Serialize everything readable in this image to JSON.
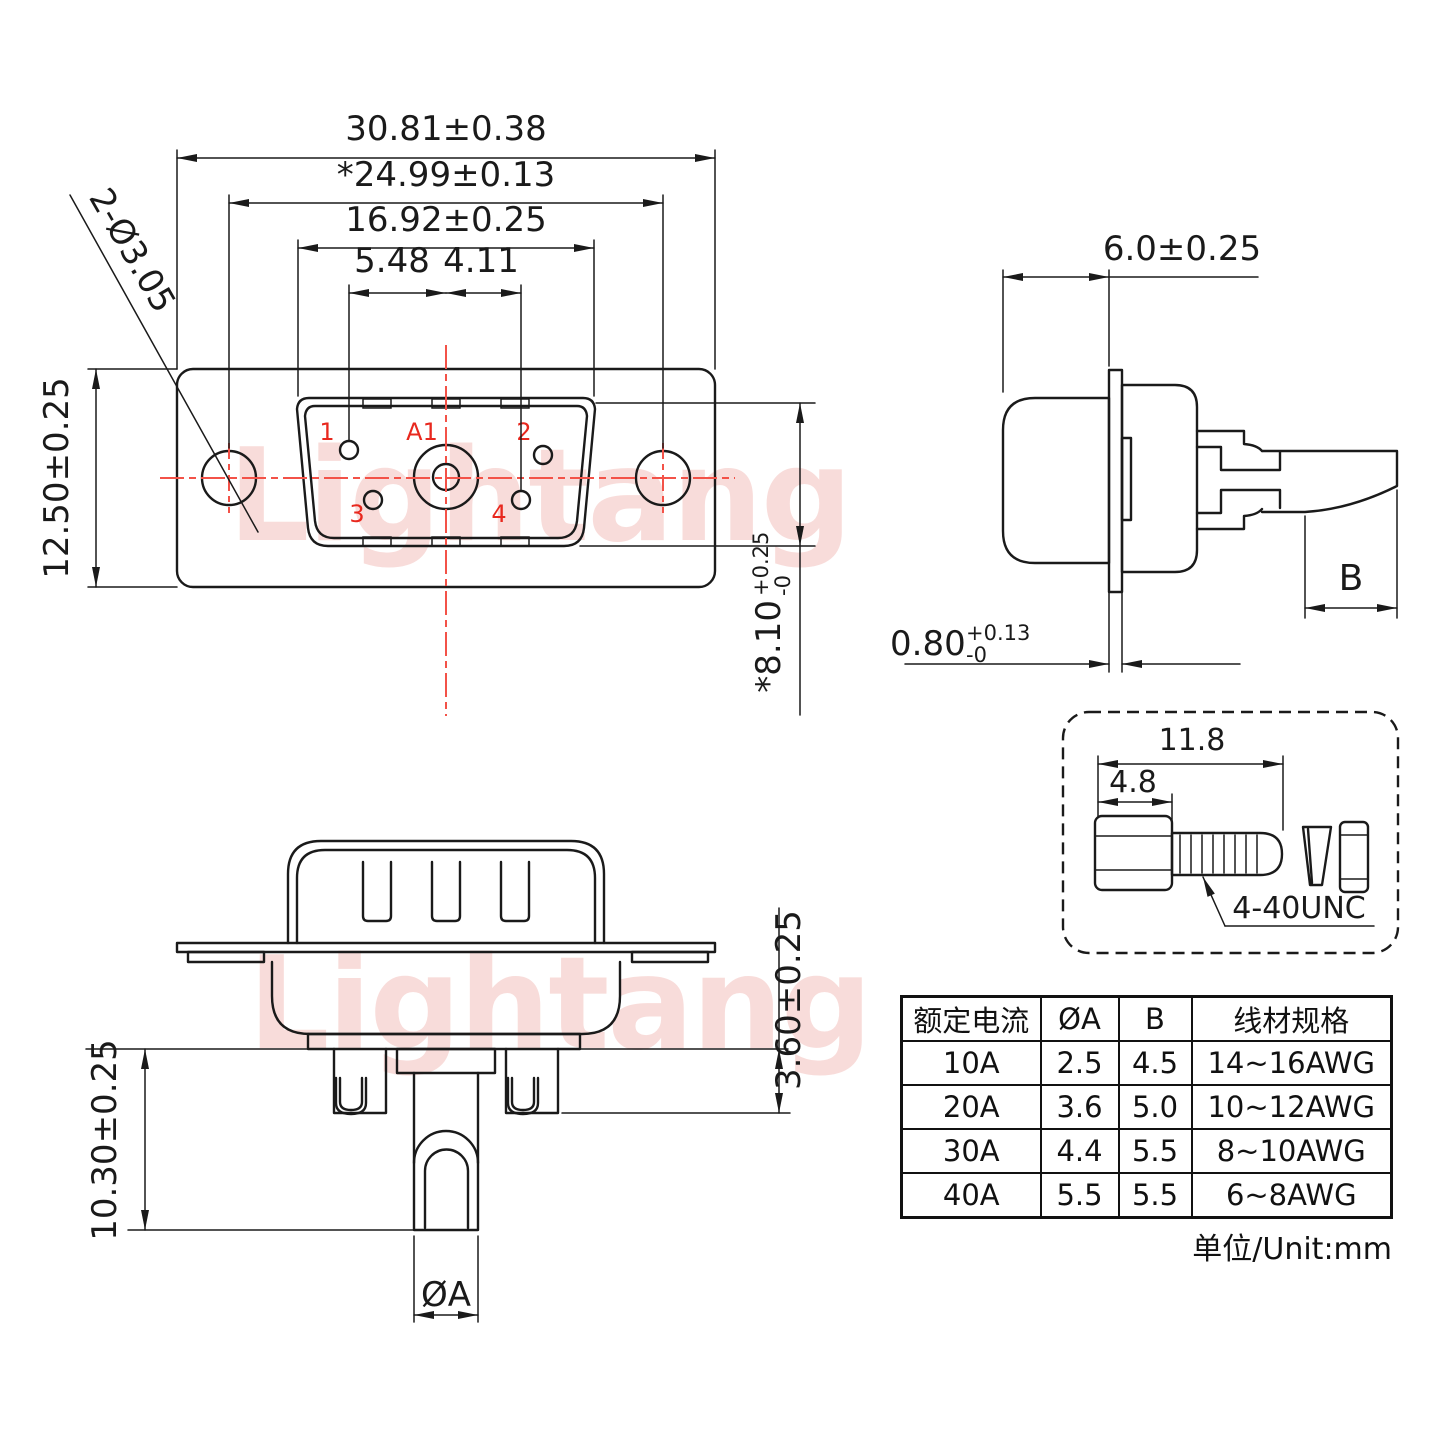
{
  "watermark": {
    "text": "Lightang"
  },
  "front_view": {
    "dim_flange_width": "30.81±0.38",
    "dim_hole_span": "*24.99±0.13",
    "dim_shell_width": "16.92±0.25",
    "dim_pin1_offset": "5.48",
    "dim_pin4_offset": "4.11",
    "dim_flange_height": "12.50±0.25",
    "dim_mount_holes": "2-Ø3.05",
    "dim_shell_height": {
      "main": "*8.10",
      "tol_plus": "+0.25",
      "tol_minus": "-0"
    },
    "pins": {
      "p1": "1",
      "p2": "2",
      "p3": "3",
      "p4": "4",
      "a1": "A1"
    }
  },
  "side_view": {
    "dim_shell_depth": "6.0±0.25",
    "dim_flange_thickness": {
      "main": "0.80",
      "tol_plus": "+0.13",
      "tol_minus": "-0"
    },
    "dim_cup_label": "B"
  },
  "rear_view": {
    "dim_cup_protrusion": "3.60±0.25",
    "dim_pin_length": "10.30±0.25",
    "dim_pin_diameter": "ØA"
  },
  "screw_detail": {
    "dim_total_length": "11.8",
    "dim_head_length": "4.8",
    "thread_spec": "4-40UNC"
  },
  "spec_table": {
    "headers": [
      "额定电流",
      "ØA",
      "B",
      "线材规格"
    ],
    "rows": [
      [
        "10A",
        "2.5",
        "4.5",
        "14~16AWG"
      ],
      [
        "20A",
        "3.6",
        "5.0",
        "10~12AWG"
      ],
      [
        "30A",
        "4.4",
        "5.5",
        "8~10AWG"
      ],
      [
        "40A",
        "5.5",
        "5.5",
        "6~8AWG"
      ]
    ],
    "unit_note": "单位/Unit:mm"
  },
  "colors": {
    "line": "#1a1a1a",
    "red_label": "#e8281e",
    "red_centerline": "#f35248",
    "watermark": "#f5c6c2"
  }
}
